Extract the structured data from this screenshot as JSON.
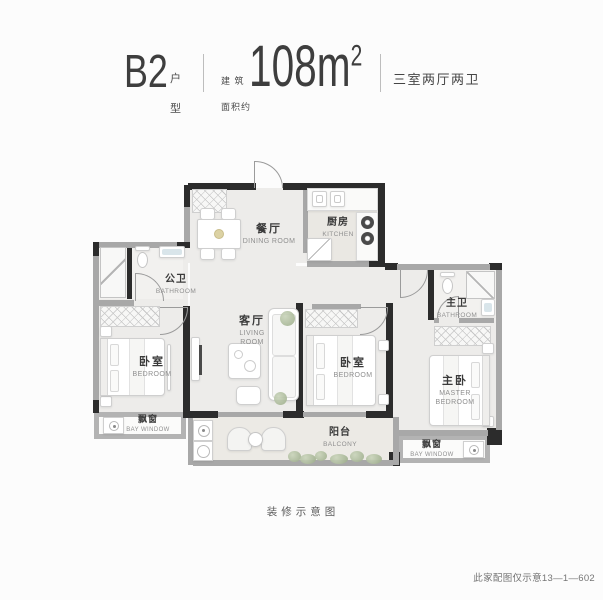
{
  "header": {
    "plan_name": "B2",
    "plan_type_top": "户",
    "plan_type_bottom": "型",
    "area_prefix_line1": "建 筑",
    "area_prefix_line2": "面积约",
    "area_value": "108m",
    "area_superscript": "2",
    "layout_summary": "三室两厅两卫"
  },
  "rooms": {
    "dining": {
      "cn": "餐厅",
      "en": "DINING ROOM"
    },
    "kitchen": {
      "cn": "厨房",
      "en": "KITCHEN"
    },
    "public_bathroom": {
      "cn": "公卫",
      "en": "BATHROOM"
    },
    "living": {
      "cn": "客厅",
      "en_line1": "LIVING",
      "en_line2": "ROOM"
    },
    "bedroom_left": {
      "cn": "卧室",
      "en": "BEDROOM"
    },
    "bedroom_middle": {
      "cn": "卧室",
      "en": "BEDROOM"
    },
    "master_bathroom": {
      "cn": "主卫",
      "en": "BATHROOM"
    },
    "master_bedroom": {
      "cn": "主卧",
      "en_line1": "MASTER",
      "en_line2": "BEDROOM"
    },
    "bay_window_left": {
      "cn": "飘窗",
      "en": "BAY WINDOW"
    },
    "balcony": {
      "cn": "阳台",
      "en": "BALCONY"
    },
    "bay_window_right": {
      "cn": "飘窗",
      "en": "BAY WINDOW"
    }
  },
  "footer": {
    "caption": "装修示意图",
    "note": "此家配图仅示意13—1—602"
  },
  "colors": {
    "wall_dark": "#2c2c2c",
    "wall_light": "#a8a8a8",
    "floor": "#edecea",
    "text_primary": "#3d3d3d",
    "text_secondary": "#8f8f8f",
    "plant_green": "#9aab88"
  },
  "icons": [
    "entry-door-arc-icon",
    "dining-table-icon",
    "chair-icon",
    "kitchen-sink-icon",
    "stove-burner-icon",
    "toilet-icon",
    "basin-icon",
    "shower-icon",
    "wardrobe-hatch-icon",
    "bed-icon",
    "nightstand-icon",
    "sofa-icon",
    "coffee-table-icon",
    "tv-icon",
    "washing-machine-icon",
    "balcony-chair-icon",
    "plant-icon",
    "bay-window-icon"
  ]
}
